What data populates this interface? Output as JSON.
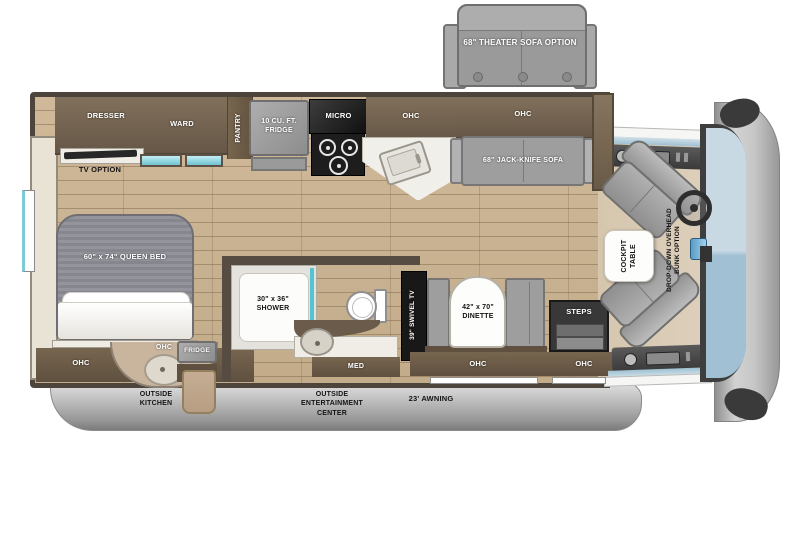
{
  "plan": {
    "theater_sofa_option": "68\" THEATER SOFA OPTION",
    "bedroom": {
      "dresser": "DRESSER",
      "ward": "WARD",
      "tv_option": "TV OPTION",
      "queen_bed": "60\" x 74\" QUEEN BED",
      "ohc": "OHC"
    },
    "kitchen": {
      "pantry": "PANTRY",
      "fridge": "10 CU. FT. FRIDGE",
      "micro": "MICRO",
      "ohc": "OHC"
    },
    "living": {
      "sofa_ohc": "OHC",
      "jack_knife_sofa": "68\" JACK-KNIFE SOFA",
      "swivel_tv": "39\" SWIVEL TV",
      "dinette": "42\" x 70\" DINETTE",
      "dinette_ohc": "OHC"
    },
    "bath": {
      "shower": "30\" x 36\" SHOWER",
      "med": "MED"
    },
    "entry": {
      "steps": "STEPS",
      "ohc": "OHC"
    },
    "cockpit": {
      "table": "COCKPIT TABLE",
      "bunk_option": "DROP-DOWN OVERHEAD BUNK OPTION"
    },
    "outside": {
      "kitchen_ohc": "OHC",
      "fridge": "FRIDGE",
      "kitchen": "OUTSIDE KITCHEN",
      "entertainment_center": "OUTSIDE ENTERTAINMENT CENTER",
      "awning": "23' AWNING"
    }
  },
  "colors": {
    "wood_floor": "#cbb493",
    "cabinet_wood": "#7b6a55",
    "cabinet_dark": "#6b5b4b",
    "appliance_gray": "#9b9b9b",
    "counter_white": "#f2f0ec",
    "window_teal": "#8ed8e2",
    "skirt_gray": "#b5b5b5",
    "windshield_blue": "#b7cedd",
    "cab_floor_tan": "#d8c9b2",
    "label_white": "#ffffff",
    "label_black": "#141414"
  }
}
